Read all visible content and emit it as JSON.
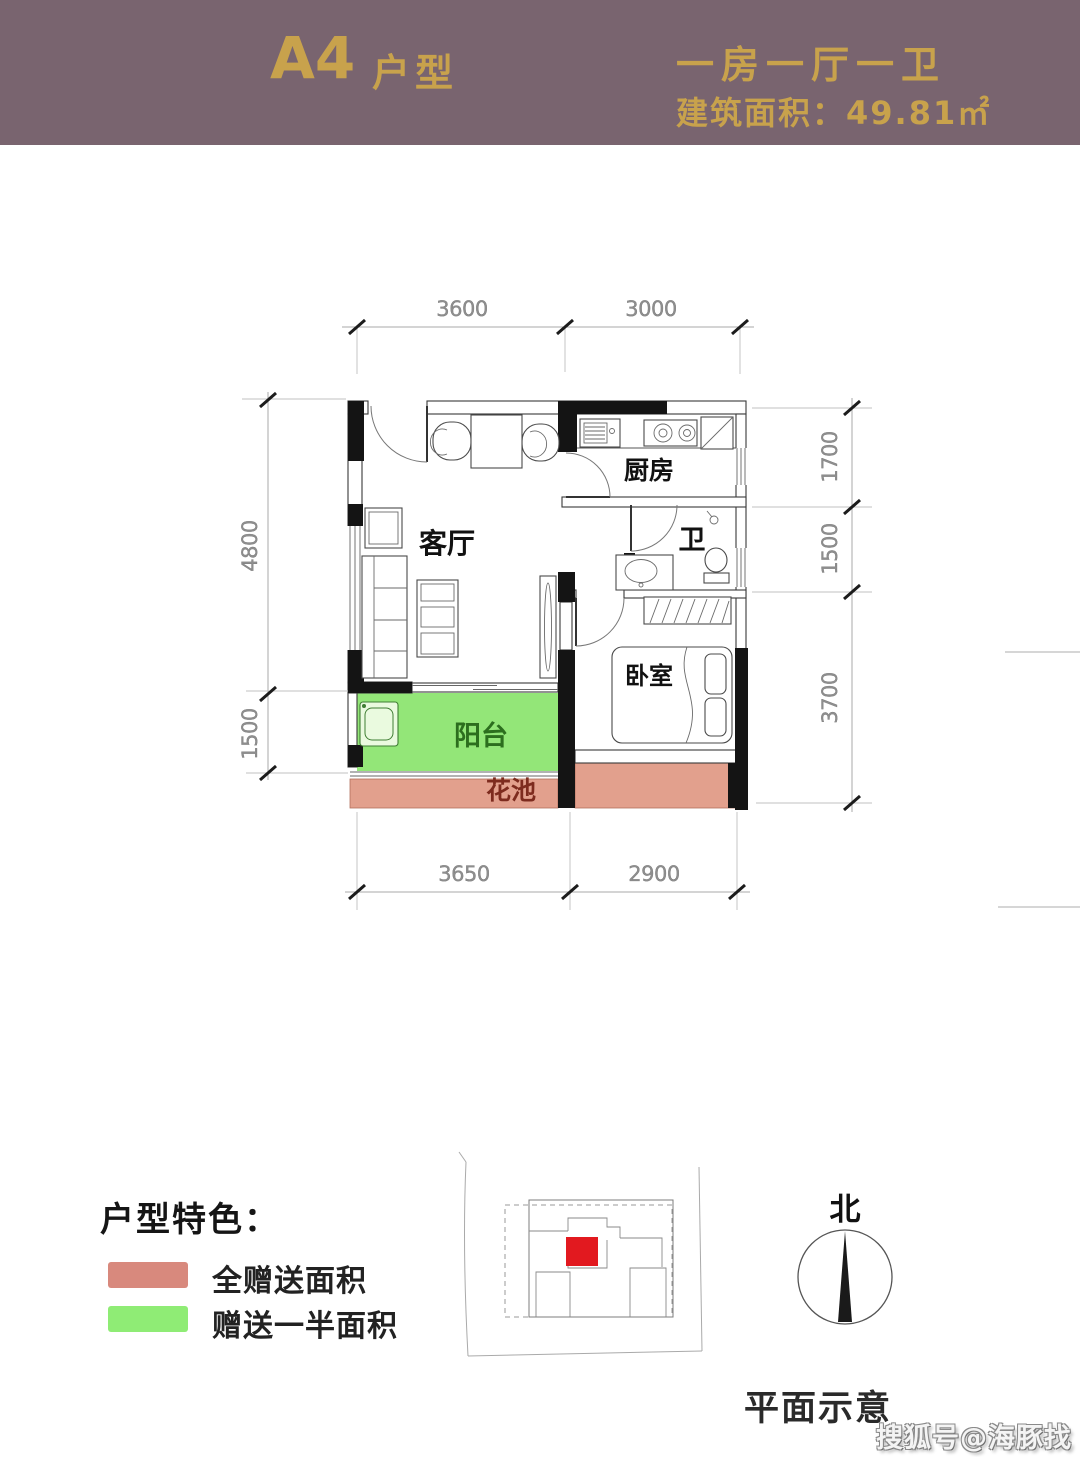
{
  "header": {
    "unit_name": "A4",
    "unit_suffix": "户型",
    "layout_type": "一房一厅一卫",
    "area_text": "建筑面积：49.81㎡",
    "bg_color": "#79646f",
    "text_color": "#c8a24c"
  },
  "floor_plan": {
    "rooms": {
      "living_room": "客厅",
      "kitchen": "厨房",
      "bathroom": "卫",
      "bedroom": "卧室",
      "balcony": "阳台",
      "flower_bed": "花池"
    },
    "dimensions_mm": {
      "top": [
        "3600",
        "3000"
      ],
      "bottom": [
        "3650",
        "2900"
      ],
      "left": [
        "4800",
        "1500"
      ],
      "right": [
        "1700",
        "1500",
        "3700"
      ]
    },
    "colors": {
      "balcony_fill": "#93e678",
      "flower_bed_fill": "#e2a08d",
      "wall": "#141414"
    }
  },
  "legend": {
    "title": "户型特色：",
    "items": [
      {
        "label": "全赠送面积",
        "color": "#d8897d"
      },
      {
        "label": "赠送一半面积",
        "color": "#8fec75"
      }
    ]
  },
  "site_plan": {
    "caption": "平面示意",
    "marker_color": "#e2191f"
  },
  "compass": {
    "north": "北"
  },
  "watermark": "搜狐号@海豚找房"
}
